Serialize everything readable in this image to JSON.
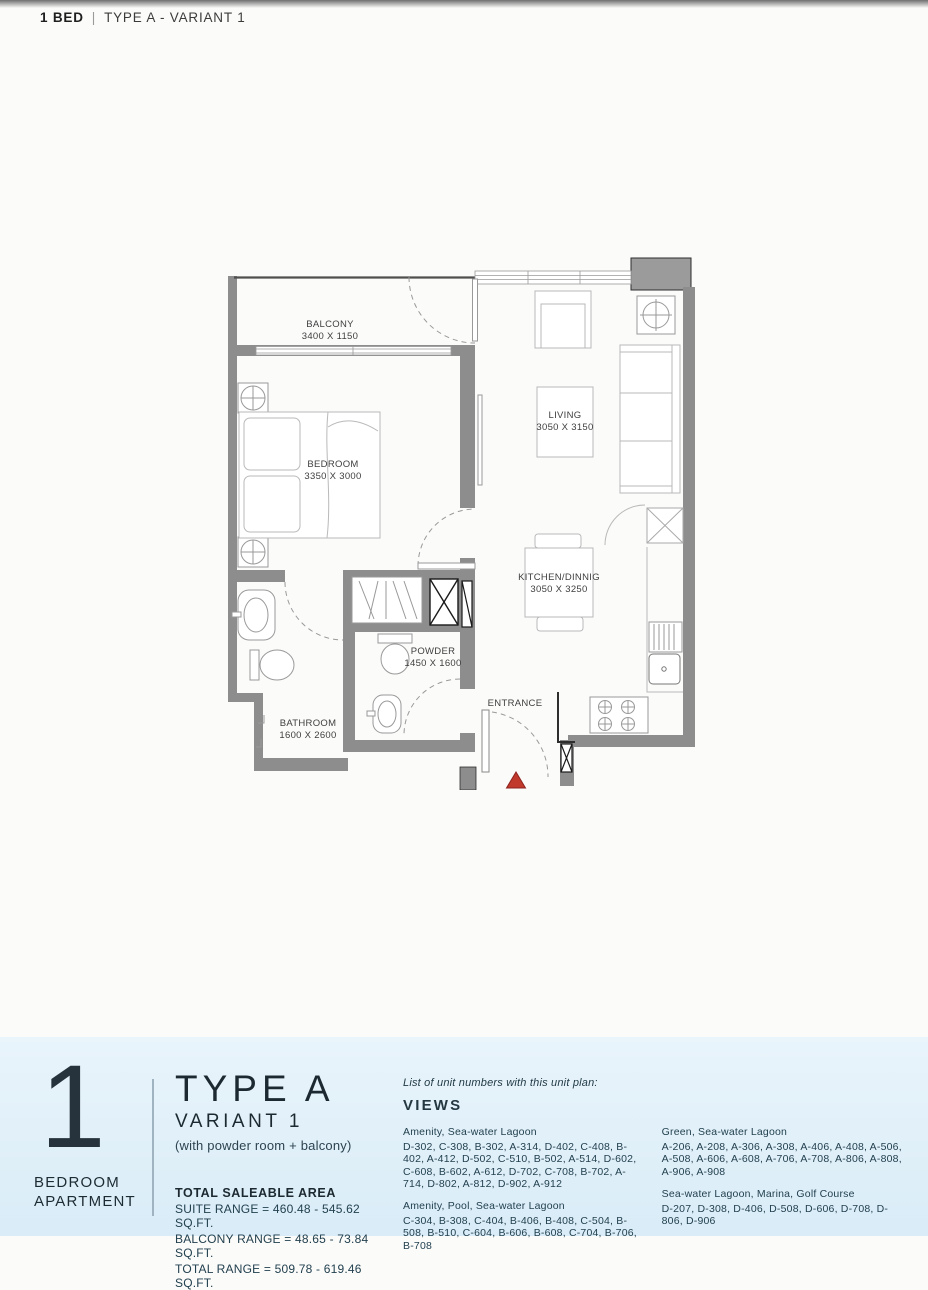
{
  "header": {
    "bold": "1 BED",
    "separator": "|",
    "rest": "TYPE A - VARIANT 1"
  },
  "floor_plan": {
    "rooms": {
      "balcony": {
        "name": "BALCONY",
        "dims": "3400 X 1150"
      },
      "bedroom": {
        "name": "BEDROOM",
        "dims": "3350 X 3000"
      },
      "living": {
        "name": "LIVING",
        "dims": "3050 X 3150"
      },
      "kitchen": {
        "name": "KITCHEN/DINNIG",
        "dims": "3050 X 3250"
      },
      "powder": {
        "name": "POWDER",
        "dims": "1450 X 1600"
      },
      "bathroom": {
        "name": "BATHROOM",
        "dims": "1600 X 2600"
      },
      "entrance": {
        "name": "ENTRANCE"
      }
    },
    "colors": {
      "wall": "#8d8d8d",
      "furniture_line": "#b9b9b9",
      "label_text": "#3f3f3f",
      "entrance_arrow": "#c0392b"
    }
  },
  "footer": {
    "unit_count": "1",
    "caption_line1": "BEDROOM",
    "caption_line2": "APARTMENT",
    "type_title": "TYPE A",
    "variant": "VARIANT 1",
    "variant_note": "(with powder room + balcony)",
    "area": {
      "heading": "TOTAL SALEABLE AREA",
      "lines": [
        "SUITE RANGE = 460.48 - 545.62 SQ.FT.",
        "BALCONY RANGE = 48.65 - 73.84 SQ.FT.",
        "TOTAL RANGE = 509.78 - 619.46 SQ.FT."
      ]
    },
    "views": {
      "intro": "List of unit numbers with this unit plan:",
      "heading": "VIEWS",
      "groups": [
        {
          "title": "Amenity, Sea-water Lagoon",
          "units": "D-302, C-308, B-302, A-314, D-402, C-408, B-402, A-412, D-502, C-510, B-502, A-514, D-602, C-608, B-602, A-612, D-702, C-708, B-702, A-714, D-802, A-812, D-902, A-912"
        },
        {
          "title": "Green, Sea-water Lagoon",
          "units": "A-206, A-208, A-306, A-308, A-406, A-408, A-506, A-508, A-606, A-608, A-706, A-708, A-806, A-808, A-906, A-908"
        },
        {
          "title": "Amenity, Pool, Sea-water Lagoon",
          "units": "C-304, B-308, C-404, B-406, B-408, C-504, B-508, B-510, C-604, B-606, B-608, C-704, B-706, B-708"
        },
        {
          "title": "Sea-water Lagoon, Marina, Golf Course",
          "units": "D-207, D-308, D-406, D-508, D-606, D-708, D-806, D-906"
        }
      ]
    },
    "colors": {
      "background_top": "#e9f4fb",
      "background_bottom": "#d9ecf7",
      "text": "#23414f"
    }
  }
}
